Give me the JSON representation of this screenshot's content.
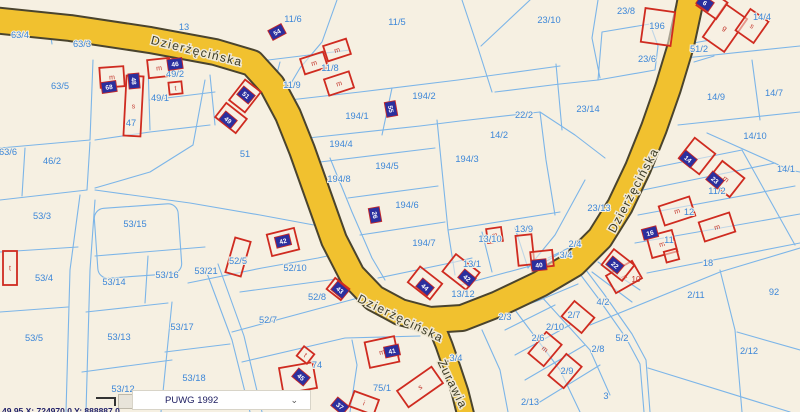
{
  "map": {
    "width": 800,
    "height": 412,
    "colors": {
      "background": "#f6f0e2",
      "parcel_line": "#7cb5e8",
      "parcel_label": "#3d87d8",
      "road_fill": "#f1c12f",
      "road_casing": "#4a442e",
      "building_outline": "#cf2b20",
      "marker_fill": "#2b2f9e",
      "marker_border": "#c62828",
      "marker_text": "#ffffff",
      "street_label": "#3a3a24"
    },
    "roads": [
      {
        "id": "dzierzecinska",
        "points": "-8,20 70,28 150,40 215,52 252,63 272,85 288,115 302,150 318,195 334,240 352,275 374,298 400,312 430,320 462,318 498,304 540,284 574,264 600,238 620,206 638,168 654,128 668,88 681,45 689,8 692,-8",
        "width": 24
      },
      {
        "id": "zurawia",
        "points": "434,320 444,345 452,368 460,392 466,416",
        "width": 15
      }
    ],
    "street_labels": [
      [
        "Dzierżęcińska",
        196,
        55,
        14
      ],
      [
        "Dzierżęcińska",
        399,
        322,
        26
      ],
      [
        "Dzierżęcińska",
        637,
        192,
        -62
      ],
      [
        "Żurawia",
        449,
        386,
        64
      ]
    ],
    "boundaries": [
      "48,20 52,44",
      "128,24 130,48",
      "93,60 90,140",
      "90,140 0,148",
      "25,148 22,196",
      "90,142 87,190",
      "0,200 87,190",
      "80,195 70,270 66,412",
      "95,200 90,270 86,412",
      "0,252 78,247",
      "0,312 68,307",
      "86,312 168,303",
      "82,372 172,360",
      "172,302 161,412",
      "165,352 230,344",
      "95,256 205,247",
      "148,256 145,303",
      "205,80 193,145 150,172 95,188",
      "95,190 190,203 260,215 330,228",
      "188,283 262,268 318,258 346,252",
      "240,292 352,277",
      "232,332 358,298",
      "242,362 345,338 420,336",
      "350,412 357,365 352,340",
      "205,268 232,340 250,412",
      "218,264 244,336 262,412",
      "337,0 322,42 300,68 287,90",
      "252,62 350,50",
      "280,62 270,100",
      "272,102 360,92 458,80 560,66",
      "462,0 478,48 492,92",
      "530,0 481,46",
      "392,88 382,135",
      "308,138 420,126 460,121 540,112",
      "320,162 435,148",
      "348,198 438,186",
      "360,235 445,222",
      "378,278 455,262 472,258",
      "330,158 352,212 372,258 385,280",
      "437,120 448,230 455,275",
      "540,112 546,160 555,215",
      "448,230 560,212",
      "482,232 492,272",
      "515,228 528,268",
      "460,285 545,262 562,252",
      "652,168 742,150",
      "643,190 775,163",
      "638,215 795,186",
      "635,243 800,214",
      "647,273 800,243",
      "742,150 795,245",
      "685,58 800,46",
      "752,60 760,120",
      "678,125 800,112",
      "707,133 790,170 800,172",
      "602,32 650,24 658,46 655,70 598,80 602,32",
      "598,0 592,38 600,78",
      "495,92 560,84 598,80",
      "556,64 562,130",
      "540,112 575,135 605,158",
      "585,180 555,235 528,268",
      "688,44 710,40",
      "694,62 714,56",
      "574,266 598,298 626,338 640,364 644,412",
      "580,262 604,294 632,334 646,360 650,412",
      "590,325 720,272 800,248",
      "648,368 790,412",
      "720,270 735,330 742,412",
      "737,332 800,350",
      "505,330 555,305",
      "515,355 570,325",
      "525,380 585,345",
      "535,405 600,365",
      "540,295 590,350 610,395",
      "515,310 560,370 580,412",
      "482,330 500,370 508,412",
      "548,258 585,240",
      "552,268 590,246",
      "598,262 640,290",
      "592,272 632,302",
      "148,64 150,130",
      "150,100 215,92",
      "95,140 150,132 210,125",
      "210,75 215,125",
      "490,318 540,300 578,284"
    ],
    "rounded_parcels": [
      [
        96,
        206,
        84,
        70,
        10,
        -4
      ]
    ],
    "parcel_labels": [
      [
        "63/4",
        20,
        38
      ],
      [
        "63/3",
        82,
        47
      ],
      [
        "13",
        184,
        30
      ],
      [
        "11/6",
        293,
        22
      ],
      [
        "11/5",
        397,
        25
      ],
      [
        "23/10",
        549,
        23
      ],
      [
        "23/8",
        626,
        14
      ],
      [
        "196",
        657,
        29
      ],
      [
        "14/4",
        762,
        20
      ],
      [
        "51/2",
        699,
        52
      ],
      [
        "23/6",
        647,
        62
      ],
      [
        "63/5",
        60,
        89
      ],
      [
        "49/2",
        175,
        77
      ],
      [
        "49/1",
        160,
        101
      ],
      [
        "11/9",
        292,
        88
      ],
      [
        "11/8",
        330,
        71
      ],
      [
        "194/2",
        424,
        99
      ],
      [
        "194/1",
        357,
        119
      ],
      [
        "22/2",
        524,
        118
      ],
      [
        "23/14",
        588,
        112
      ],
      [
        "14/9",
        716,
        100
      ],
      [
        "14/7",
        774,
        96
      ],
      [
        "47",
        131,
        126
      ],
      [
        "63/6",
        8,
        155
      ],
      [
        "46/2",
        52,
        164
      ],
      [
        "51",
        245,
        157
      ],
      [
        "194/4",
        341,
        147
      ],
      [
        "194/8",
        339,
        182
      ],
      [
        "194/5",
        387,
        169
      ],
      [
        "194/3",
        467,
        162
      ],
      [
        "14/2",
        499,
        138
      ],
      [
        "14/10",
        755,
        139
      ],
      [
        "14/1",
        786,
        172
      ],
      [
        "53/3",
        42,
        219
      ],
      [
        "53/15",
        135,
        227
      ],
      [
        "194/6",
        407,
        208
      ],
      [
        "23/13",
        599,
        211
      ],
      [
        "11/2",
        717,
        194
      ],
      [
        "12",
        689,
        215
      ],
      [
        "11",
        669,
        243
      ],
      [
        "18",
        708,
        266
      ],
      [
        "13/9",
        524,
        232
      ],
      [
        "13/10",
        490,
        242
      ],
      [
        "194/7",
        424,
        246
      ],
      [
        "2/4",
        575,
        247
      ],
      [
        "3/4",
        566,
        258
      ],
      [
        "13/1",
        472,
        267
      ],
      [
        "13/12",
        463,
        297
      ],
      [
        "53/16",
        167,
        278
      ],
      [
        "53/21",
        206,
        274
      ],
      [
        "52/5",
        238,
        264
      ],
      [
        "52/10",
        295,
        271
      ],
      [
        "53/4",
        44,
        281
      ],
      [
        "53/14",
        114,
        285
      ],
      [
        "52/8",
        317,
        300
      ],
      [
        "52/7",
        268,
        323
      ],
      [
        "53/5",
        34,
        341
      ],
      [
        "53/13",
        119,
        340
      ],
      [
        "53/17",
        182,
        330
      ],
      [
        "53/18",
        194,
        381
      ],
      [
        "53/12",
        123,
        392
      ],
      [
        "74",
        317,
        368
      ],
      [
        "75/1",
        382,
        391
      ],
      [
        "92",
        774,
        295
      ],
      [
        "2/3",
        505,
        320
      ],
      [
        "2/7",
        574,
        318
      ],
      [
        "2/10",
        555,
        330
      ],
      [
        "2/6",
        538,
        341
      ],
      [
        "2/8",
        598,
        352
      ],
      [
        "2/9",
        567,
        374
      ],
      [
        "3",
        606,
        399
      ],
      [
        "2/13",
        530,
        405
      ],
      [
        "2/11",
        696,
        298
      ],
      [
        "2/12",
        749,
        354
      ],
      [
        "3/4",
        456,
        361
      ],
      [
        "4/2",
        603,
        305
      ],
      [
        "5/2",
        622,
        341
      ]
    ],
    "red_labels": [
      [
        "10",
        636,
        282
      ]
    ],
    "buildings": [
      [
        100,
        67,
        24,
        20,
        -4,
        "m"
      ],
      [
        125,
        76,
        17,
        60,
        3,
        "s"
      ],
      [
        148,
        59,
        22,
        18,
        -6,
        "m"
      ],
      [
        169,
        82,
        13,
        12,
        -6,
        "t"
      ],
      [
        235,
        83,
        20,
        26,
        38,
        ""
      ],
      [
        218,
        109,
        26,
        18,
        38,
        "m"
      ],
      [
        302,
        55,
        24,
        16,
        -18,
        "m"
      ],
      [
        325,
        42,
        24,
        16,
        -18,
        "m"
      ],
      [
        326,
        75,
        26,
        17,
        -18,
        "m"
      ],
      [
        643,
        10,
        30,
        34,
        8,
        ""
      ],
      [
        712,
        8,
        26,
        40,
        35,
        "g"
      ],
      [
        741,
        13,
        22,
        26,
        35,
        "s"
      ],
      [
        700,
        -6,
        24,
        20,
        35,
        ""
      ],
      [
        487,
        228,
        15,
        14,
        -8,
        "m"
      ],
      [
        517,
        235,
        16,
        30,
        -6,
        ""
      ],
      [
        531,
        251,
        22,
        16,
        -6,
        ""
      ],
      [
        446,
        261,
        30,
        22,
        38,
        ""
      ],
      [
        411,
        273,
        28,
        20,
        38,
        ""
      ],
      [
        329,
        282,
        18,
        14,
        38,
        ""
      ],
      [
        269,
        231,
        28,
        22,
        -14,
        "m"
      ],
      [
        230,
        239,
        16,
        36,
        16,
        ""
      ],
      [
        3,
        251,
        14,
        34,
        0,
        "t"
      ],
      [
        281,
        365,
        34,
        26,
        -10,
        "m"
      ],
      [
        299,
        349,
        13,
        12,
        38,
        "t"
      ],
      [
        351,
        395,
        26,
        16,
        20,
        "i"
      ],
      [
        367,
        339,
        30,
        26,
        -12,
        "m"
      ],
      [
        399,
        377,
        42,
        20,
        -35,
        "s"
      ],
      [
        535,
        335,
        20,
        28,
        40,
        "m"
      ],
      [
        555,
        357,
        20,
        28,
        40,
        "m"
      ],
      [
        565,
        307,
        26,
        20,
        40,
        ""
      ],
      [
        609,
        267,
        30,
        20,
        -30,
        "m"
      ],
      [
        712,
        167,
        28,
        24,
        38,
        "m"
      ],
      [
        684,
        143,
        26,
        26,
        38,
        ""
      ],
      [
        661,
        201,
        32,
        20,
        -18,
        "m"
      ],
      [
        701,
        217,
        32,
        20,
        -18,
        "m"
      ],
      [
        649,
        233,
        26,
        22,
        -15,
        "m"
      ],
      [
        605,
        255,
        26,
        20,
        38,
        "m"
      ],
      [
        665,
        250,
        13,
        11,
        -15,
        ""
      ]
    ],
    "markers": [
      [
        109,
        87,
        -8,
        "68"
      ],
      [
        134,
        81,
        85,
        "48"
      ],
      [
        175,
        64,
        -8,
        "46"
      ],
      [
        246,
        95,
        40,
        "51"
      ],
      [
        228,
        120,
        40,
        "49"
      ],
      [
        277,
        32,
        -28,
        "54"
      ],
      [
        391,
        109,
        80,
        "55"
      ],
      [
        375,
        215,
        80,
        "26"
      ],
      [
        688,
        159,
        40,
        "14"
      ],
      [
        715,
        180,
        40,
        "23"
      ],
      [
        650,
        233,
        -15,
        "16"
      ],
      [
        615,
        265,
        40,
        "22"
      ],
      [
        539,
        265,
        -6,
        "40"
      ],
      [
        340,
        290,
        40,
        "43"
      ],
      [
        425,
        287,
        40,
        "44"
      ],
      [
        467,
        278,
        40,
        "42"
      ],
      [
        283,
        241,
        -14,
        "42"
      ],
      [
        301,
        377,
        40,
        "45"
      ],
      [
        392,
        351,
        -12,
        "41"
      ],
      [
        340,
        406,
        40,
        "37"
      ],
      [
        705,
        3,
        35,
        "6"
      ]
    ]
  },
  "statusbar": {
    "crs_label": "PUWG 1992",
    "chevron": "⌄",
    "coords_text": "49,95 X: 724970,0  Y: 888887,0"
  }
}
